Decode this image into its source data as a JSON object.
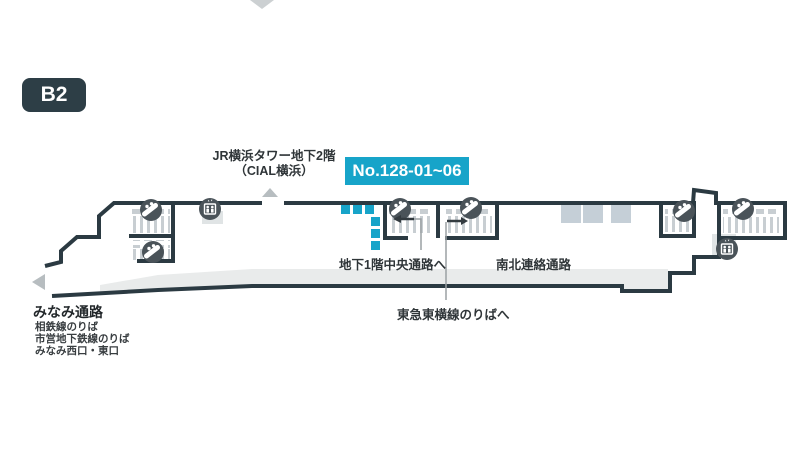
{
  "floor": {
    "badge": "B2"
  },
  "annotations": {
    "building": {
      "line1": "JR横浜タワー地下2階",
      "line2": "（CIAL横浜）"
    },
    "sign_number": "No.128-01~06",
    "passage_b1_central": "地下1階中央通路へ",
    "passage_north_south": "南北連絡通路",
    "tokyu_line": "東急東横線のりばへ",
    "minami_passage": {
      "title": "みなみ通路",
      "sub": [
        "相鉄線のりば",
        "市営地下鉄線のりば",
        "みなみ西口・東口"
      ]
    }
  },
  "markers": {
    "sign_location_count": 6,
    "escalator_icon_count": 6,
    "elevator_icon_count": 2
  },
  "colors": {
    "accent_cyan": "#17a4c9",
    "wall_dark": "#2b3a42",
    "icon_circle_gray": "#4a5359",
    "walkway_gray": "#e9ebeb",
    "structure_bluegray": "#c5cfd7"
  }
}
